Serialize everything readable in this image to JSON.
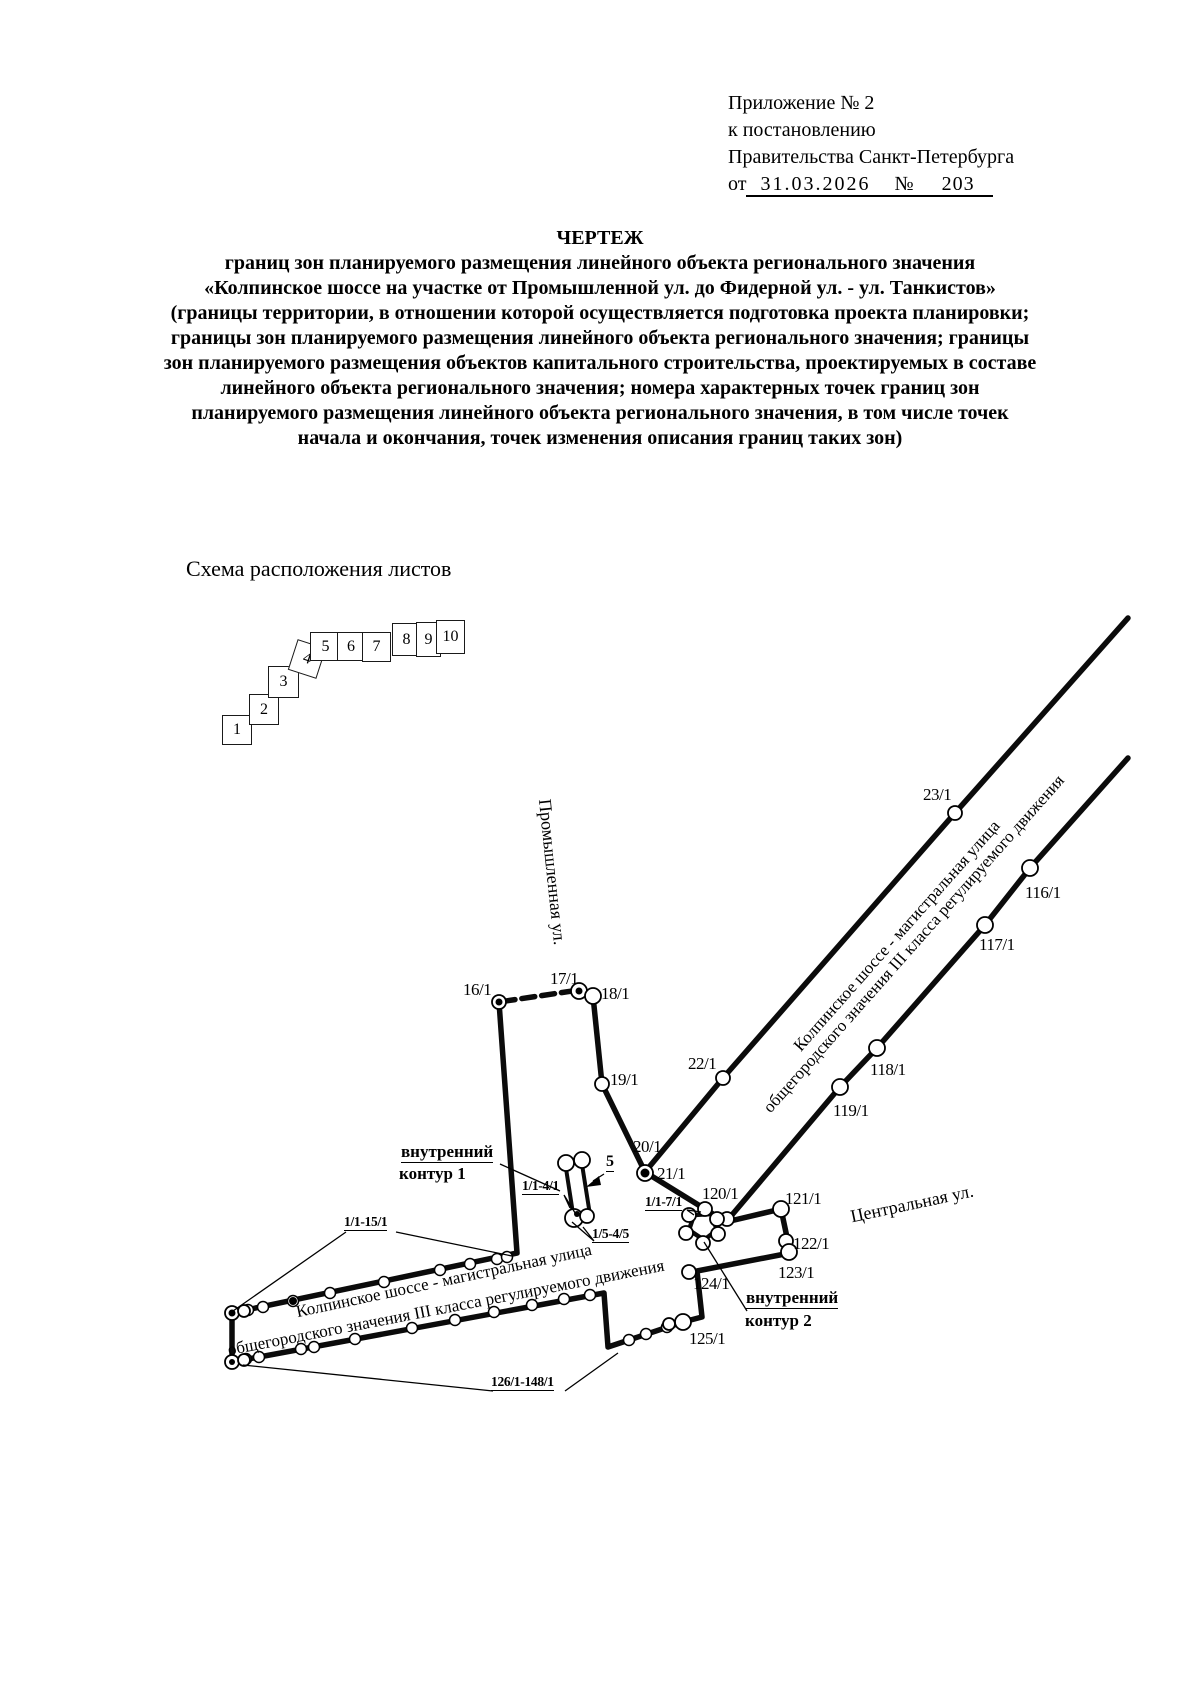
{
  "header": {
    "line1": "Приложение № 2",
    "line2": "к постановлению",
    "line3": "Правительства Санкт-Петербурга",
    "date_prefix": "от",
    "date": "31.03.2026",
    "number_sign": "№",
    "number": "203"
  },
  "title": {
    "heading": "ЧЕРТЕЖ",
    "lines": [
      "границ зон планируемого размещения линейного объекта регионального значения",
      "«Колпинское шоссе на участке от Промышленной ул. до Фидерной ул. - ул. Танкистов»",
      "(границы территории, в отношении которой осуществляется подготовка проекта планировки;",
      "границы зон планируемого размещения линейного объекта регионального значения; границы",
      "зон планируемого размещения объектов капитального строительства, проектируемых в составе",
      "линейного объекта регионального значения; номера характерных точек границ зон",
      "планируемого размещения линейного объекта регионального значения, в том числе точек",
      "начала и окончания, точек изменения описания границ таких зон)"
    ]
  },
  "scheme": {
    "caption": "Схема расположения листов",
    "sheets": [
      "1",
      "2",
      "3",
      "4",
      "5",
      "6",
      "7",
      "8",
      "9",
      "10"
    ]
  },
  "map": {
    "road_labels": {
      "kolp_upper_1": "Колпинское шоссе - магистральная улица",
      "kolp_upper_2": "общегородского значения III класса регулируемого движения",
      "kolp_lower_1": "Колпинское шоссе - магистральная улица",
      "kolp_lower_2": "общегородского значения III класса регулируемого движения",
      "promyshlennaya": "Промышленная ул.",
      "tsentralnaya": "Центральная ул."
    },
    "points": {
      "p16": "16/1",
      "p17": "17/1",
      "p18": "18/1",
      "p19": "19/1",
      "p20": "20/1",
      "p21": "21/1",
      "p22": "22/1",
      "p23": "23/1",
      "p116": "116/1",
      "p117": "117/1",
      "p118": "118/1",
      "p119": "119/1",
      "p120": "120/1",
      "p121": "121/1",
      "p122": "122/1",
      "p123": "123/1",
      "p124": "124/1",
      "p125": "125/1"
    },
    "ranges": {
      "r1": "1/1-4/1",
      "r2": "1/5-4/5",
      "r3": "1/1-7/1",
      "r4": "1/1-15/1",
      "r5": "126/1-148/1",
      "sheet5": "5"
    },
    "annotations": {
      "inner1_line1": "внутренний",
      "inner1_line2": "контур 1",
      "inner2_line1": "внутренний",
      "inner2_line2": "контур 2"
    }
  }
}
